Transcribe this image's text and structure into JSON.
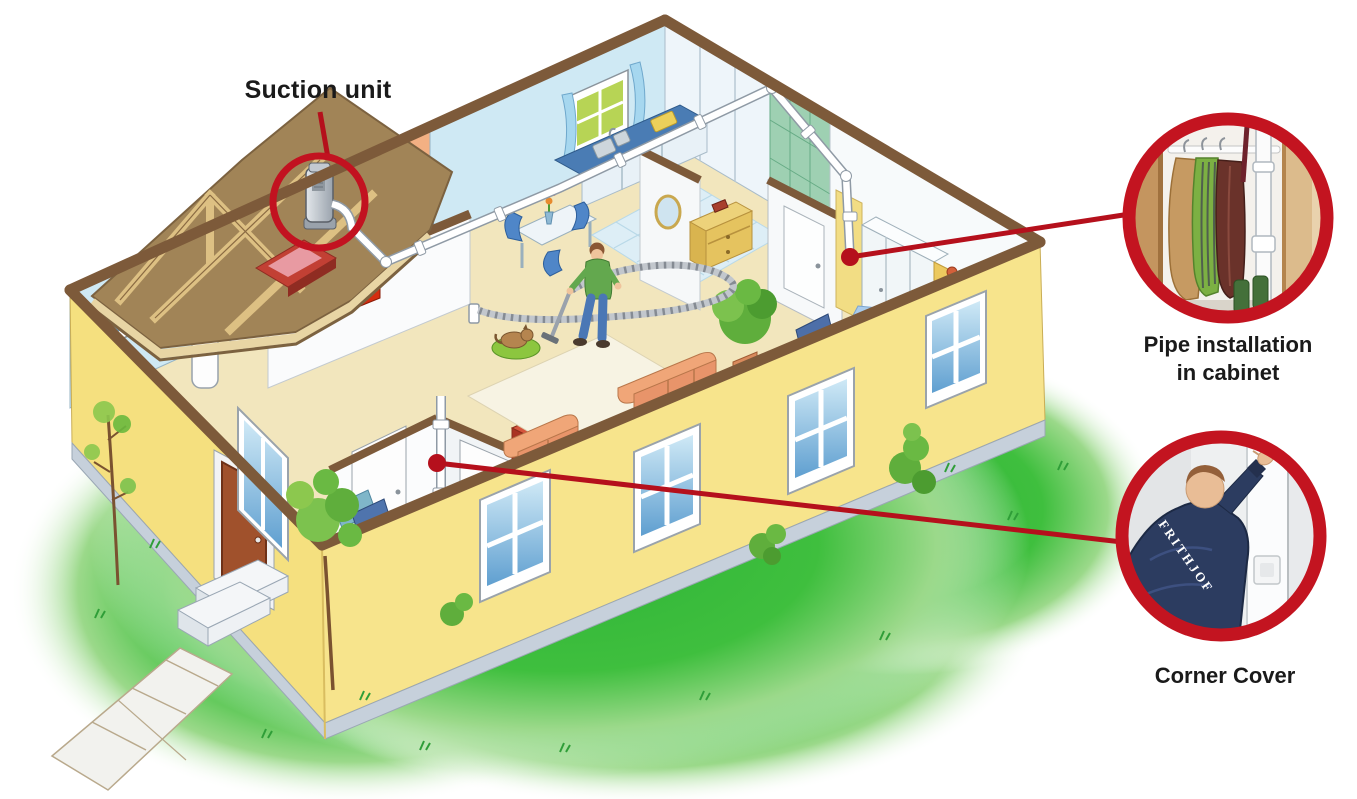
{
  "colors": {
    "accent_red": "#c21220",
    "leader_red": "#b5101c",
    "house_yellow": "#f6e286",
    "plinth_gray": "#c6d0db",
    "lawn_green": "#3cb93c",
    "roof_brown": "#a18457",
    "cap_brown": "#7d5a3a",
    "pipe_white": "#ffffff"
  },
  "callouts": {
    "suction_unit": {
      "label": "Suction unit"
    },
    "pipe_cabinet": {
      "caption_line1": "Pipe installation",
      "caption_line2": "in cabinet"
    },
    "corner_cover": {
      "caption": "Corner Cover"
    }
  },
  "insets": {
    "jacket_back_text": "FRITHJOF"
  },
  "scene": {
    "objects": [
      "suction-unit",
      "vacuum-pipe-network",
      "wall-inlet",
      "corner-cover-pipe",
      "person-vacuuming",
      "vacuum-hose",
      "sofa",
      "loveseat",
      "coffee-table",
      "potted-plant",
      "pet-on-pet-bed",
      "dining-table",
      "kitchen-counter",
      "kitchen-sink",
      "shower-tiles",
      "bedroom-wardrobe",
      "bed",
      "bathroom-boiler",
      "bathtub",
      "front-door",
      "doormat",
      "entry-steps",
      "walkway",
      "lawn",
      "trees",
      "red-chalkboard",
      "attic-rafters",
      "roof-hatch",
      "oval-mirror",
      "dresser",
      "computer-desk",
      "guitar",
      "poster"
    ]
  }
}
